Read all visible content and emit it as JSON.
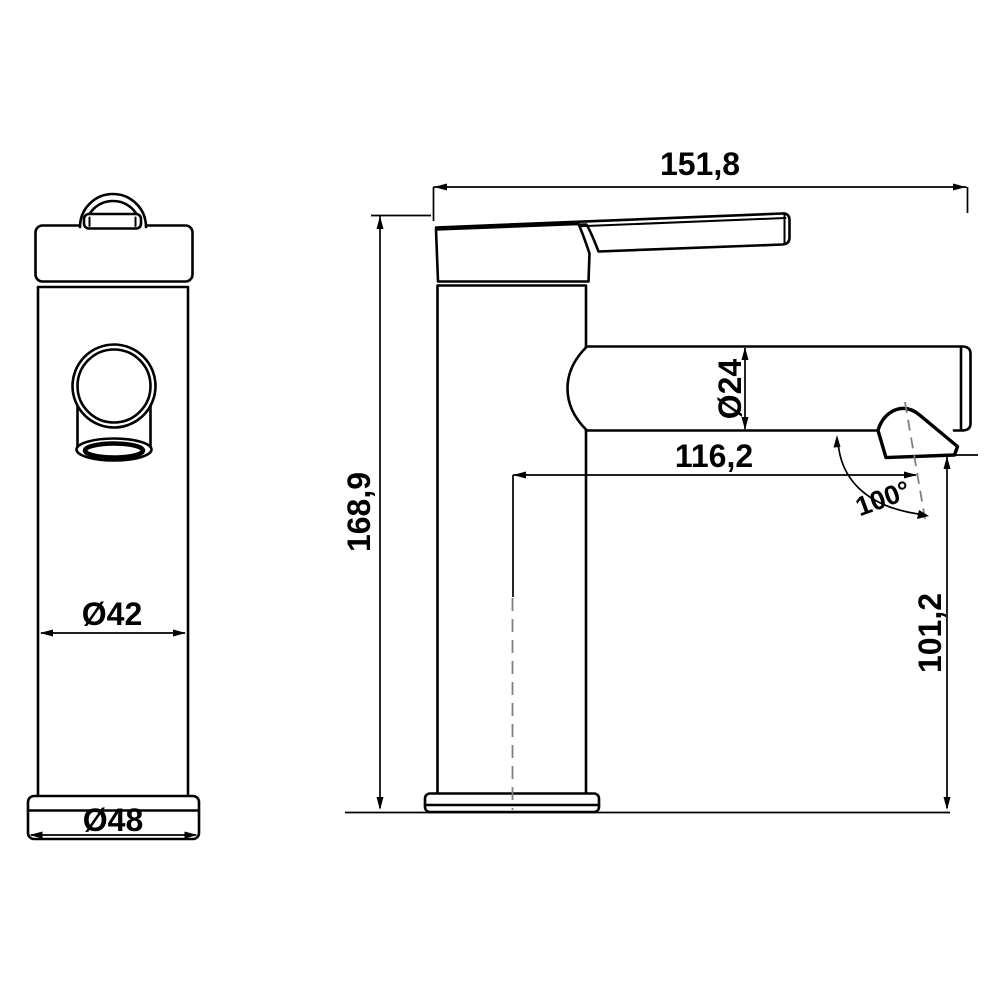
{
  "drawing": {
    "background": "#ffffff",
    "line_color": "#000000",
    "centerline_color": "#808080",
    "dimensions": {
      "total_width": "151,8",
      "total_height": "168,9",
      "spout_diameter": "Ø24",
      "spout_reach": "116,2",
      "outlet_angle": "100°",
      "outlet_height": "101,2",
      "body_diameter": "Ø42",
      "base_diameter": "Ø48"
    }
  }
}
